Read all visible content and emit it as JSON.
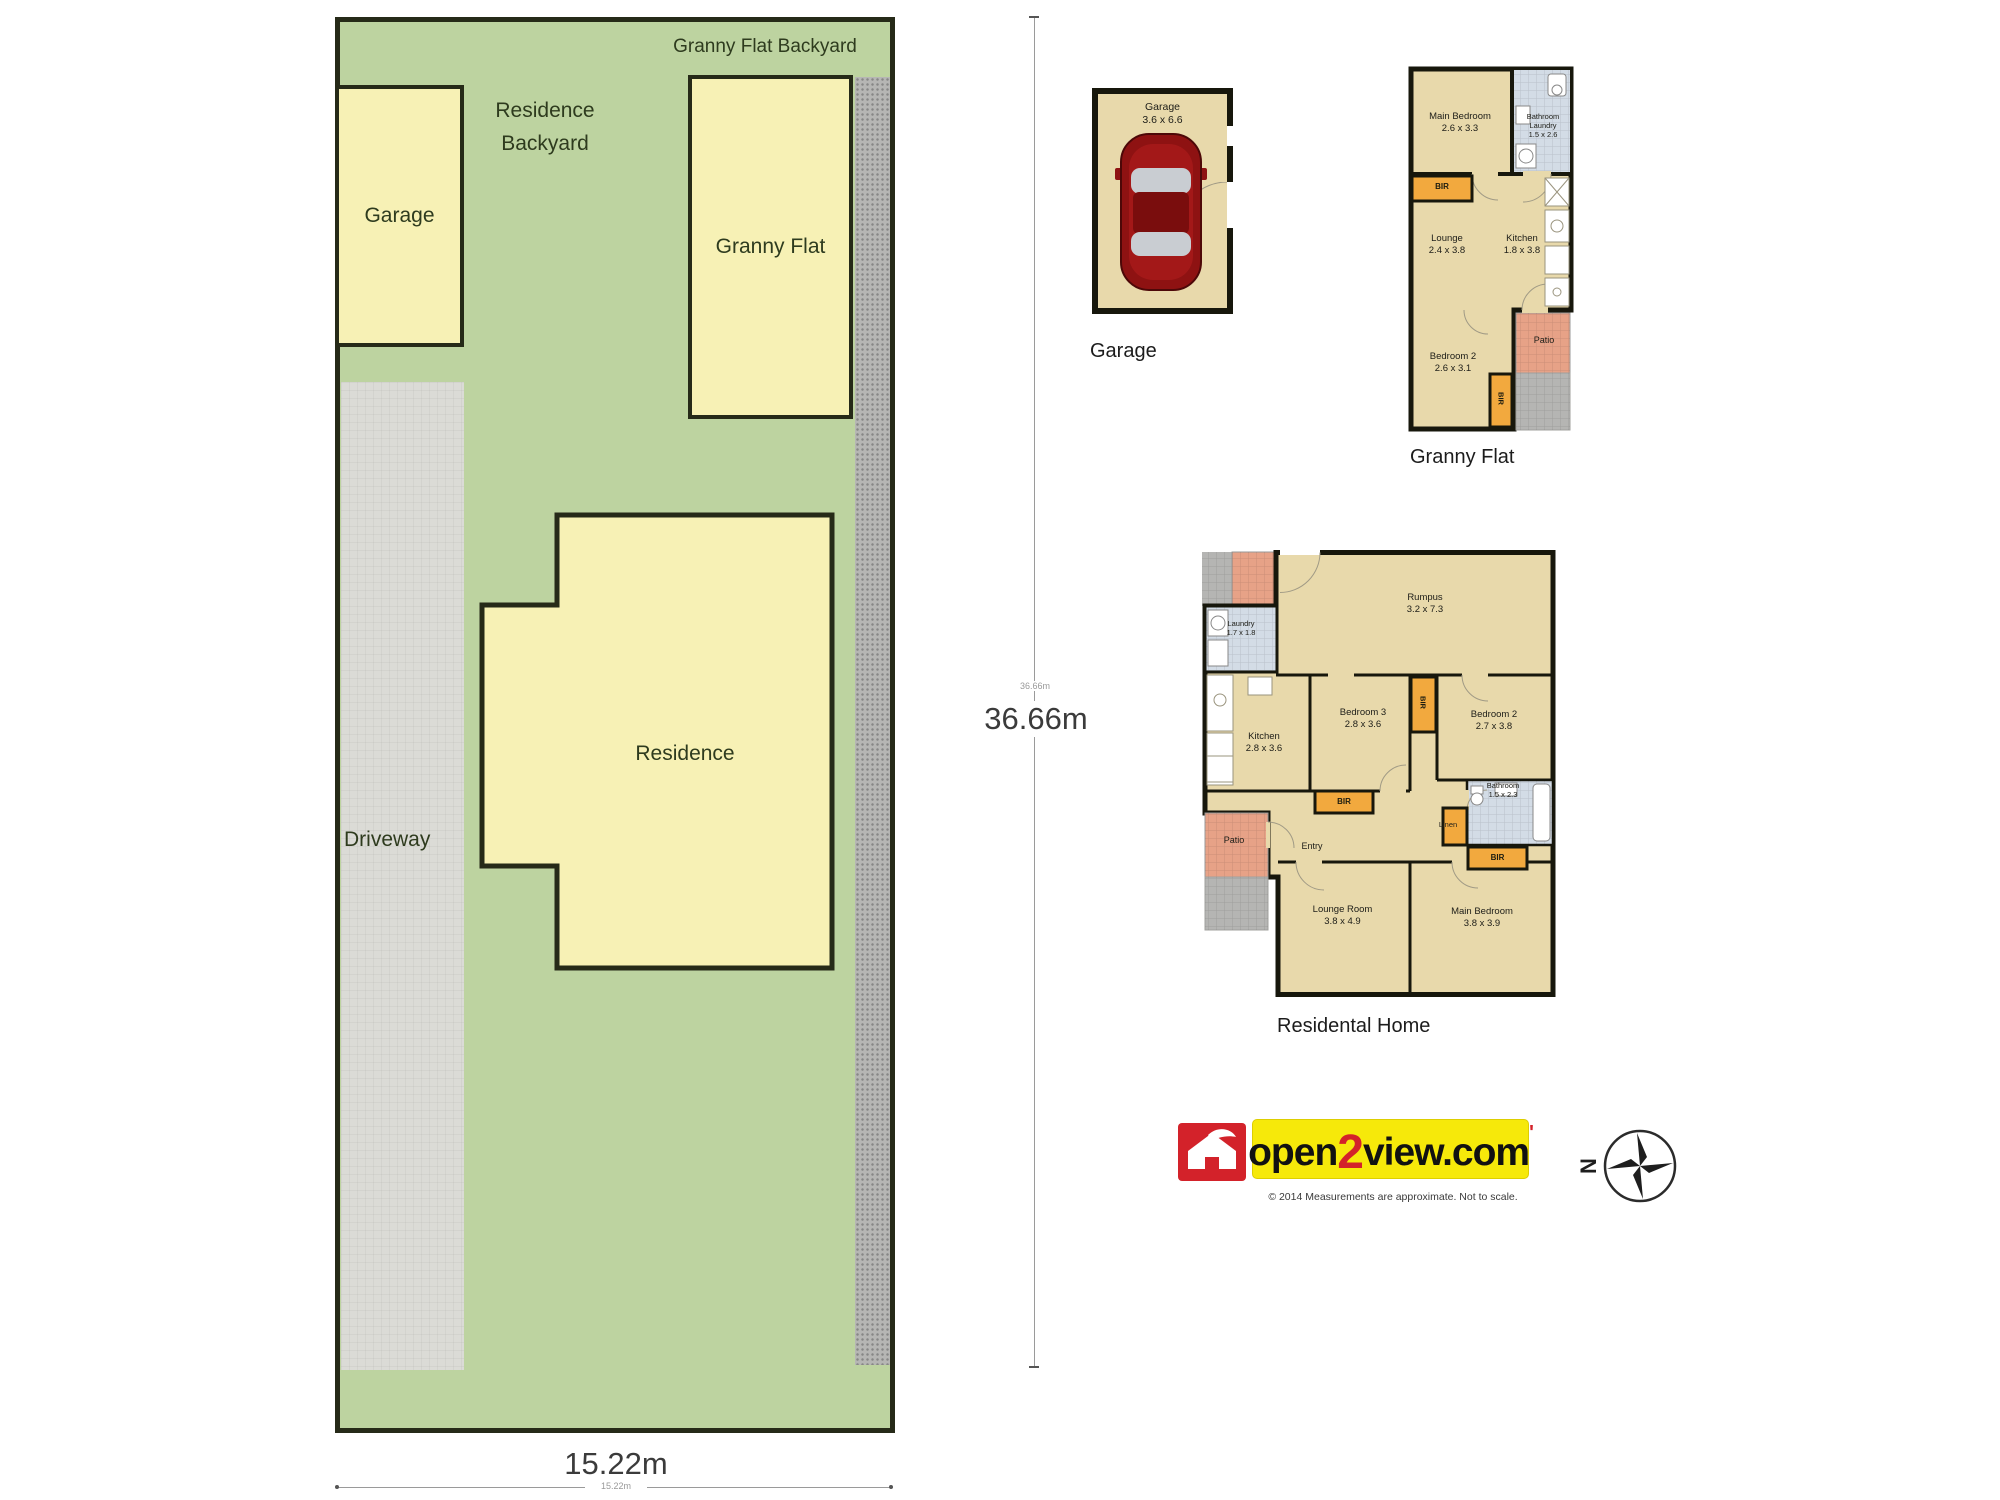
{
  "site": {
    "granny_flat_backyard": "Granny Flat Backyard",
    "residence_backyard_1": "Residence",
    "residence_backyard_2": "Backyard",
    "garage": "Garage",
    "granny_flat": "Granny Flat",
    "residence": "Residence",
    "driveway": "Driveway",
    "depth_dim": "36.66m",
    "depth_dim_small": "36.66m",
    "width_dim": "15.22m",
    "width_dim_small": "15.22m"
  },
  "plans": {
    "garage": {
      "title": "Garage",
      "room": "Garage",
      "dims": "3.6 x 6.6"
    },
    "granny": {
      "title": "Granny Flat",
      "main_bedroom": "Main Bedroom",
      "main_bedroom_dims": "2.6 x 3.3",
      "bathroom": "Bathroom",
      "laundry": "Laundry",
      "bathroom_dims": "1.5 x 2.6",
      "lounge": "Lounge",
      "lounge_dims": "2.4 x 3.8",
      "kitchen": "Kitchen",
      "kitchen_dims": "1.8 x 3.8",
      "bedroom2": "Bedroom 2",
      "bedroom2_dims": "2.6 x 3.1",
      "patio": "Patio",
      "bir": "BIR"
    },
    "residential": {
      "title": "Residental Home",
      "rumpus": "Rumpus",
      "rumpus_dims": "3.2 x 7.3",
      "laundry": "Laundry",
      "laundry_dims": "1.7 x 1.8",
      "kitchen": "Kitchen",
      "kitchen_dims": "2.8 x 3.6",
      "bedroom3": "Bedroom 3",
      "bedroom3_dims": "2.8 x 3.6",
      "bedroom2": "Bedroom 2",
      "bedroom2_dims": "2.7 x 3.8",
      "bathroom": "Bathroom",
      "bathroom_dims": "1.5 x 2.3",
      "entry": "Entry",
      "linen": "Linen",
      "lounge_room": "Lounge Room",
      "lounge_room_dims": "3.8 x 4.9",
      "main_bedroom": "Main Bedroom",
      "main_bedroom_dims": "3.8 x 3.9",
      "patio": "Patio",
      "bir": "BIR"
    }
  },
  "branding": {
    "logo_open": "open",
    "logo_2": "2",
    "logo_view": "view.com",
    "logo_mark": "'",
    "tagline": "© 2014 Measurements are approximate. Not to scale.",
    "compass_n": "N"
  },
  "colors": {
    "lot_green": "#bdd3a0",
    "building_yellow": "#f7f1b5",
    "floor_tan": "#e8d9ab",
    "wall_black": "#17170c",
    "bir_orange": "#f2a93e",
    "patio_pink": "#e7a287",
    "tile_blue": "#d3dce6",
    "concrete_gray": "#b5b5b3",
    "logo_red": "#d3222a",
    "logo_yellow": "#f6e90a"
  }
}
